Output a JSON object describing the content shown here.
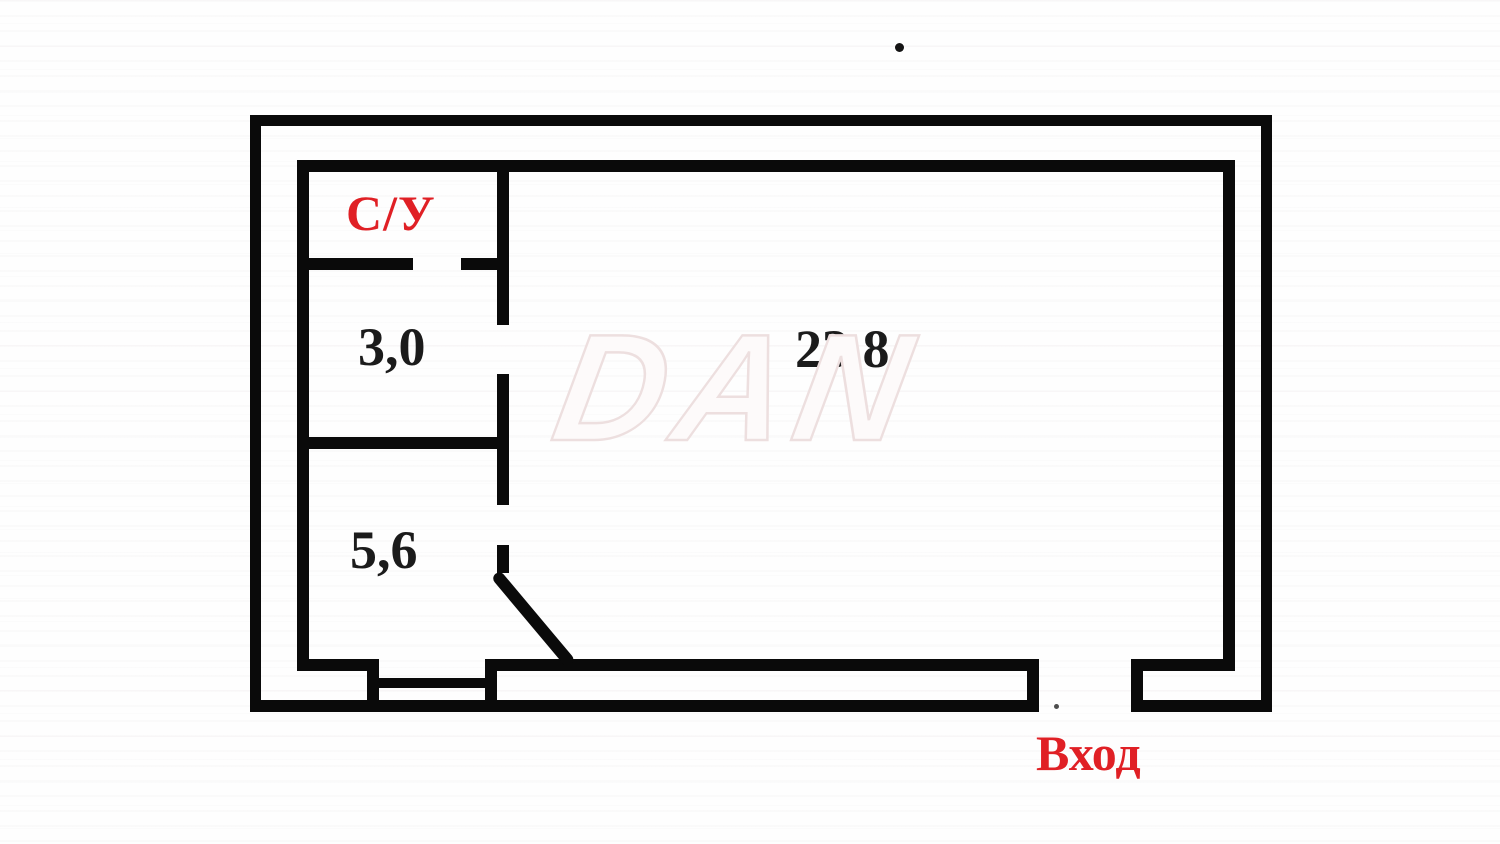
{
  "plan": {
    "rooms": [
      {
        "name": "bathroom",
        "label": "С/У"
      },
      {
        "name": "room-3-0",
        "label": "3,0",
        "area_m2": 3.0
      },
      {
        "name": "room-5-6",
        "label": "5,6",
        "area_m2": 5.6
      },
      {
        "name": "main-room",
        "label": "23,8",
        "area_m2": 23.8
      }
    ],
    "entrance": {
      "label": "Вход"
    },
    "watermark": "DAN",
    "colors": {
      "wall": "#0a0a0a",
      "red_label": "#e02025",
      "black_label": "#1b1b1b",
      "watermark_fill": "#fdfafa",
      "background": "#fefefe"
    },
    "walls": [
      {
        "name": "outer-wall-top",
        "x": 250,
        "y": 115,
        "w": 1022,
        "h": 11
      },
      {
        "name": "outer-wall-left",
        "x": 250,
        "y": 115,
        "w": 11,
        "h": 597
      },
      {
        "name": "outer-wall-right",
        "x": 1261,
        "y": 115,
        "w": 11,
        "h": 597
      },
      {
        "name": "outer-wall-bottom-left",
        "x": 250,
        "y": 700,
        "w": 789,
        "h": 12
      },
      {
        "name": "outer-wall-bottom-right",
        "x": 1131,
        "y": 700,
        "w": 141,
        "h": 12
      },
      {
        "name": "inner-wall-top",
        "x": 297,
        "y": 160,
        "w": 938,
        "h": 12
      },
      {
        "name": "inner-wall-left",
        "x": 297,
        "y": 160,
        "w": 12,
        "h": 511
      },
      {
        "name": "inner-wall-right",
        "x": 1223,
        "y": 160,
        "w": 12,
        "h": 511
      },
      {
        "name": "inner-wall-bottom-small-room",
        "x": 297,
        "y": 659,
        "w": 70,
        "h": 12
      },
      {
        "name": "window-jamb-left",
        "x": 367,
        "y": 659,
        "w": 12,
        "h": 53
      },
      {
        "name": "window-sill",
        "x": 379,
        "y": 678,
        "w": 106,
        "h": 10
      },
      {
        "name": "window-jamb-right",
        "x": 485,
        "y": 659,
        "w": 12,
        "h": 53
      },
      {
        "name": "inner-wall-bottom-main",
        "x": 497,
        "y": 659,
        "w": 535,
        "h": 12
      },
      {
        "name": "entrance-jamb-left",
        "x": 1027,
        "y": 659,
        "w": 12,
        "h": 53
      },
      {
        "name": "entrance-jamb-right",
        "x": 1131,
        "y": 659,
        "w": 12,
        "h": 53
      },
      {
        "name": "inner-wall-bottom-right",
        "x": 1143,
        "y": 659,
        "w": 92,
        "h": 12
      },
      {
        "name": "bathroom-wall-bottom-left",
        "x": 297,
        "y": 258,
        "w": 116,
        "h": 12
      },
      {
        "name": "bathroom-wall-bottom-right",
        "x": 461,
        "y": 258,
        "w": 48,
        "h": 12
      },
      {
        "name": "partition-wall-middle",
        "x": 297,
        "y": 437,
        "w": 212,
        "h": 12
      },
      {
        "name": "central-wall-top",
        "x": 497,
        "y": 160,
        "w": 12,
        "h": 165
      },
      {
        "name": "central-wall-mid",
        "x": 497,
        "y": 374,
        "w": 12,
        "h": 131
      },
      {
        "name": "central-wall-low",
        "x": 497,
        "y": 545,
        "w": 12,
        "h": 28
      },
      {
        "name": "door-leaf",
        "x": 500,
        "y": 570,
        "w": 118,
        "h": 12,
        "rotate": 50
      }
    ],
    "dots": [
      {
        "name": "stray-dot-top",
        "x": 895,
        "y": 43,
        "size": 9,
        "color": "#141414"
      },
      {
        "name": "stray-dot-entrance",
        "x": 1054,
        "y": 704,
        "size": 5,
        "color": "#4d4d4d"
      }
    ]
  }
}
